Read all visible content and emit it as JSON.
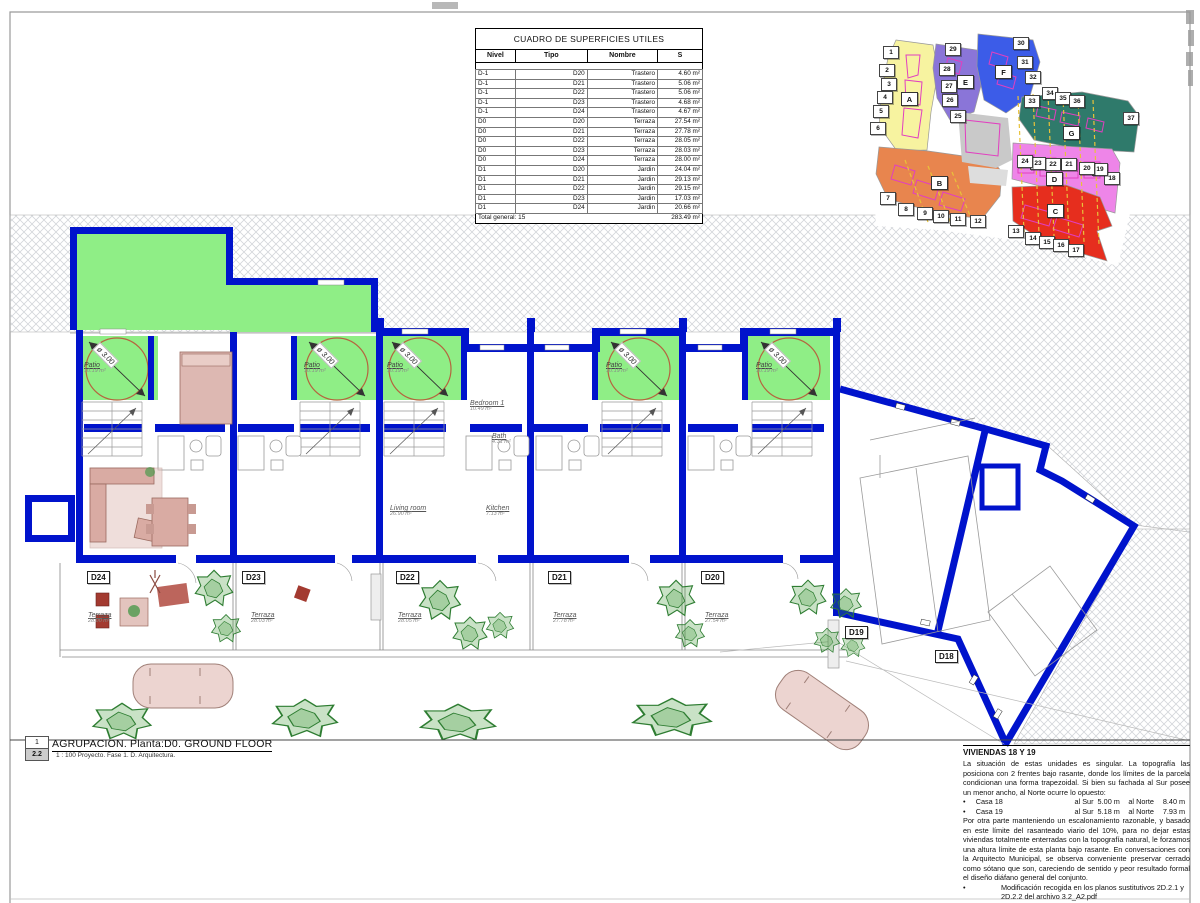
{
  "table": {
    "title": "CUADRO DE SUPERFICIES UTILES",
    "columns": [
      "Nivel",
      "Tipo",
      "Nombre",
      "S"
    ],
    "rows": [
      [
        "D-1",
        "D20",
        "Trastero",
        "4.60 m²"
      ],
      [
        "D-1",
        "D21",
        "Trastero",
        "5.06 m²"
      ],
      [
        "D-1",
        "D22",
        "Trastero",
        "5.06 m²"
      ],
      [
        "D-1",
        "D23",
        "Trastero",
        "4.68 m²"
      ],
      [
        "D-1",
        "D24",
        "Trastero",
        "4.67 m²"
      ],
      [
        "D0",
        "D20",
        "Terraza",
        "27.54 m²"
      ],
      [
        "D0",
        "D21",
        "Terraza",
        "27.78 m²"
      ],
      [
        "D0",
        "D22",
        "Terraza",
        "28.05 m²"
      ],
      [
        "D0",
        "D23",
        "Terraza",
        "28.03 m²"
      ],
      [
        "D0",
        "D24",
        "Terraza",
        "28.00 m²"
      ],
      [
        "D1",
        "D20",
        "Jardin",
        "24.04 m²"
      ],
      [
        "D1",
        "D21",
        "Jardin",
        "29.13 m²"
      ],
      [
        "D1",
        "D22",
        "Jardin",
        "29.15 m²"
      ],
      [
        "D1",
        "D23",
        "Jardin",
        "17.03 m²"
      ],
      [
        "D1",
        "D24",
        "Jardin",
        "20.66 m²"
      ]
    ],
    "total_label": "Total general: 15",
    "total_value": "283.49 m²"
  },
  "key_map": {
    "zone_letters": [
      "A",
      "B",
      "C",
      "D",
      "E",
      "F",
      "G"
    ],
    "numbers": [
      "1",
      "2",
      "3",
      "4",
      "5",
      "6",
      "7",
      "8",
      "9",
      "10",
      "11",
      "12",
      "13",
      "14",
      "15",
      "16",
      "17",
      "18",
      "19",
      "20",
      "21",
      "22",
      "23",
      "24",
      "25",
      "26",
      "27",
      "28",
      "29",
      "30",
      "31",
      "32",
      "33",
      "34",
      "35",
      "36",
      "37"
    ]
  },
  "plan": {
    "units": [
      {
        "id": "D24",
        "terrace_label": "Terraza",
        "terrace_area": "28.00 m²"
      },
      {
        "id": "D23",
        "terrace_label": "Terraza",
        "terrace_area": "28.03 m²"
      },
      {
        "id": "D22",
        "terrace_label": "Terraza",
        "terrace_area": "28.05 m²"
      },
      {
        "id": "D21",
        "terrace_label": "Terraza",
        "terrace_area": "27.78 m²"
      },
      {
        "id": "D20",
        "terrace_label": "Terraza",
        "terrace_area": "27.54 m²"
      },
      {
        "id": "D19"
      },
      {
        "id": "D18"
      }
    ],
    "patio": {
      "label": "Patio",
      "area": "10.19 m²",
      "diameter": "ø 3.00"
    },
    "room_labels": {
      "bedroom": "Bedroom 1",
      "bedroom_area": "10.49 m²",
      "bath": "Bath",
      "bath_area": "4.31 m²",
      "living": "Living room",
      "living_area": "26.90 m²",
      "kitchen": "Kitchen",
      "kitchen_area": "7.13 m²"
    }
  },
  "title_block": {
    "index_top": "1",
    "index_bottom": "2.2",
    "title": "AGRUPACION. Planta:D0. GROUND FLOOR",
    "subtitle": "1 : 100 Proyecto. Fase 1. D. Arquitectura."
  },
  "notes": {
    "title": "VIVIENDAS 18 Y 19",
    "para1": "La situación de estas unidades es singular. La topografía las posiciona con 2 frentes bajo rasante, donde los límites de la parcela condicionan una forma trapezoidal. Si bien su fachada al Sur posee un menor ancho, al Norte ocurre lo opuesto:",
    "bullets": [
      {
        "name": "Casa 18",
        "sur_label": "al Sur",
        "sur": "5.00 m",
        "norte_label": "al Norte",
        "norte": "8.40 m"
      },
      {
        "name": "Casa 19",
        "sur_label": "al Sur",
        "sur": "5.18 m",
        "norte_label": "al Norte",
        "norte": "7.93 m"
      }
    ],
    "para2": "Por otra parte manteniendo un escalonamiento razonable, y basado en este límite del rasanteado viario del 10%, para no dejar estas viviendas totalmente enterradas con la topografía natural, le forzamos una altura límite de esta planta bajo rasante. En conversaciones con la Arquitecto Municipal, se observa conveniente preservar cerrado como sótano que son, careciendo de sentido y peor resultado formal el diseño diáfano general del conjunto.",
    "bullet2": "Modificación recogida en los planos sustitutivos 2D.2.1 y 2D.2.2 del archivo 3.2_A2.pdf"
  },
  "colors": {
    "wall_blue": "#0013cc",
    "patio_green": "#8fee86",
    "zone_a": "#f7f3a0",
    "zone_b": "#e8854e",
    "zone_c": "#e62e1e",
    "zone_d": "#ee85e8",
    "zone_e": "#8a75d8",
    "zone_f": "#3c5ce8",
    "zone_g": "#2f7a6b"
  }
}
